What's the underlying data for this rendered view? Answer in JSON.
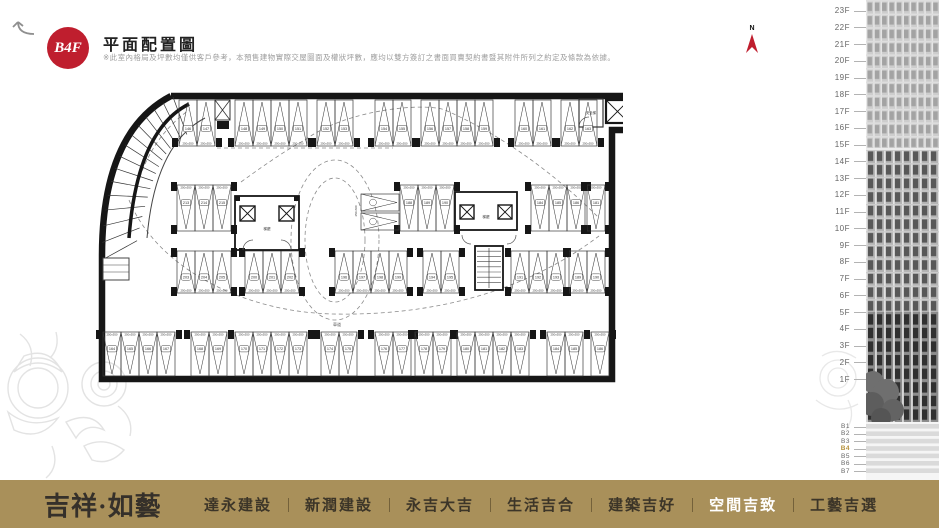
{
  "header": {
    "badge": "B4F",
    "badge_color": "#bf1e2e",
    "title": "平面配置圖",
    "disclaimer": "※此室內格局及坪數均僅供客戶參考，本預售建物實際交屋圖面及權狀坪數，應均以雙方簽訂之書面買賣契約書暨其附件所列之約定及條款為依據。"
  },
  "compass": {
    "label": "N",
    "arrow_color": "#bf1e2e"
  },
  "floors": {
    "above": [
      "23F",
      "22F",
      "21F",
      "20F",
      "19F",
      "18F",
      "17F",
      "16F",
      "15F",
      "14F",
      "13F",
      "12F",
      "11F",
      "10F",
      "9F",
      "8F",
      "7F",
      "6F",
      "5F",
      "4F",
      "3F",
      "2F",
      "1F"
    ],
    "below": [
      "B1",
      "B2",
      "B3",
      "B4",
      "B5",
      "B6",
      "B7"
    ],
    "active": "B4",
    "active_color": "#b5913c"
  },
  "plan": {
    "dim_v": "250x550",
    "dim_h": "250x600",
    "labels": {
      "lobby": "梯廳",
      "safe_stair": "安全梯",
      "drive": "車道"
    },
    "rows": [
      {
        "name": "top",
        "y": 12,
        "h": 46,
        "dir": "up",
        "dimpos": "bottom",
        "groups": [
          {
            "x": 86,
            "count": 2,
            "start": 146
          },
          {
            "x": 142,
            "count": 4,
            "start": 148
          },
          {
            "x": 224,
            "count": 2,
            "start": 152
          },
          {
            "x": 282,
            "count": 2,
            "start": 154
          },
          {
            "x": 328,
            "count": 4,
            "start": 156
          },
          {
            "x": 422,
            "count": 2,
            "start": 160
          },
          {
            "x": 468,
            "count": 2,
            "start": 162
          }
        ]
      },
      {
        "name": "mid-upper",
        "y": 97,
        "h": 46,
        "dir": "down",
        "dimpos": "top",
        "groups": [
          {
            "x": 84,
            "count": 3,
            "start": 213
          },
          {
            "x": 307,
            "count": 3,
            "start": 188
          },
          {
            "x": 438,
            "count": 3,
            "start": 184
          },
          {
            "x": 494,
            "count": 1,
            "start": 181
          }
        ]
      },
      {
        "name": "mid-lower",
        "y": 163,
        "h": 42,
        "dir": "up",
        "dimpos": "bottom",
        "groups": [
          {
            "x": 84,
            "count": 3,
            "start": 203
          },
          {
            "x": 152,
            "count": 3,
            "start": 200
          },
          {
            "x": 242,
            "count": 4,
            "start": 196
          },
          {
            "x": 330,
            "count": 2,
            "start": 194
          },
          {
            "x": 418,
            "count": 3,
            "start": 191
          },
          {
            "x": 476,
            "count": 2,
            "start": 189
          }
        ]
      },
      {
        "name": "bottom",
        "y": 244,
        "h": 44,
        "dir": "down",
        "dimpos": "top",
        "groups": [
          {
            "x": 10,
            "count": 4,
            "start": 164
          },
          {
            "x": 98,
            "count": 2,
            "start": 168
          },
          {
            "x": 142,
            "count": 4,
            "start": 170
          },
          {
            "x": 228,
            "count": 2,
            "start": 174
          },
          {
            "x": 282,
            "count": 2,
            "start": 176
          },
          {
            "x": 322,
            "count": 2,
            "start": 178
          },
          {
            "x": 364,
            "count": 4,
            "start": 180
          },
          {
            "x": 454,
            "count": 2,
            "start": 184
          },
          {
            "x": 498,
            "count": 1,
            "start": 186
          }
        ]
      }
    ]
  },
  "footer": {
    "logo": "吉祥·如藝",
    "bg": "#a9905a",
    "nav": [
      {
        "label": "達永建設",
        "active": false
      },
      {
        "label": "新潤建設",
        "active": false
      },
      {
        "label": "永吉大吉",
        "active": false
      },
      {
        "label": "生活吉合",
        "active": false
      },
      {
        "label": "建築吉好",
        "active": false
      },
      {
        "label": "空間吉致",
        "active": true
      },
      {
        "label": "工藝吉選",
        "active": false
      }
    ]
  }
}
